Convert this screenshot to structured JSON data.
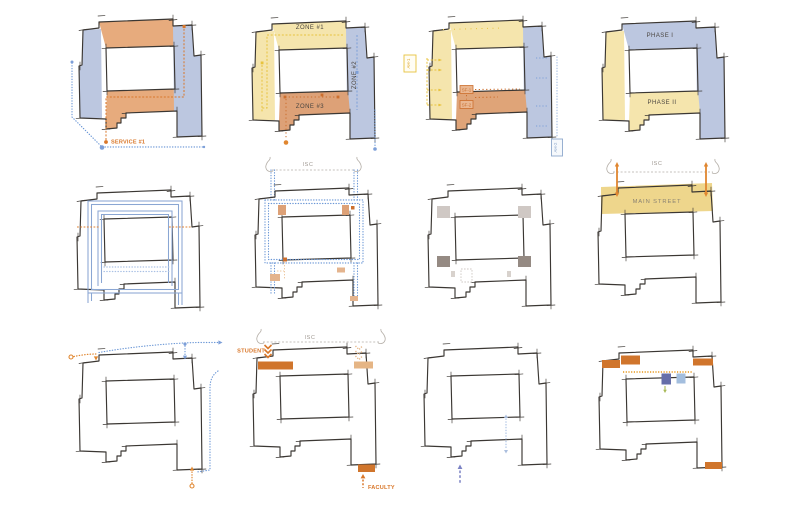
{
  "figure": {
    "rows": 3,
    "cols": 4,
    "background": "#ffffff",
    "style": "hand-drawn concept floor-plan diagrams"
  },
  "colors": {
    "ink": "#3b3733",
    "fill_blue": "#bcc7e0",
    "fill_yellow": "#f5e5ad",
    "fill_orange": "#e7ab7d",
    "fill_orange_deep": "#dda177",
    "fill_mainstreet": "#eed68c",
    "accent_orange": "#d9772a",
    "accent_orange_bright": "#e0862f",
    "accent_yellow": "#e8c33e",
    "accent_blue": "#7d9fd8",
    "accent_blue_light": "#a9c0e4",
    "accent_purple": "#7b82c4",
    "accent_green": "#a8b957",
    "block_purple": "#666ea9",
    "block_blue_light": "#a3bede",
    "gray_light": "#cfc8c4",
    "gray_dark": "#958a83",
    "label_gray": "#9d968f",
    "label_dark": "#4a4540",
    "label_tan": "#8a8272"
  },
  "panels": {
    "service_zoning": {
      "service1": "SERVICE #1"
    },
    "zones": {
      "zone1": "ZONE #1",
      "zone2": "ZONE #2",
      "zone3": "ZONE #3"
    },
    "air_systems": {
      "ah1": "AH-1",
      "ah2": "AH-2",
      "sf1": "SF-1",
      "sf2": "SF-2"
    },
    "phasing": {
      "phase1": "PHASE I",
      "phase2": "PHASE II"
    },
    "isc_loop": {
      "isc": "ISC"
    },
    "main_street": {
      "isc": "ISC",
      "main_street": "MAIN STREET"
    },
    "entries": {
      "isc": "ISC",
      "student": "STUDENT",
      "faculty": "FACULTY"
    }
  }
}
